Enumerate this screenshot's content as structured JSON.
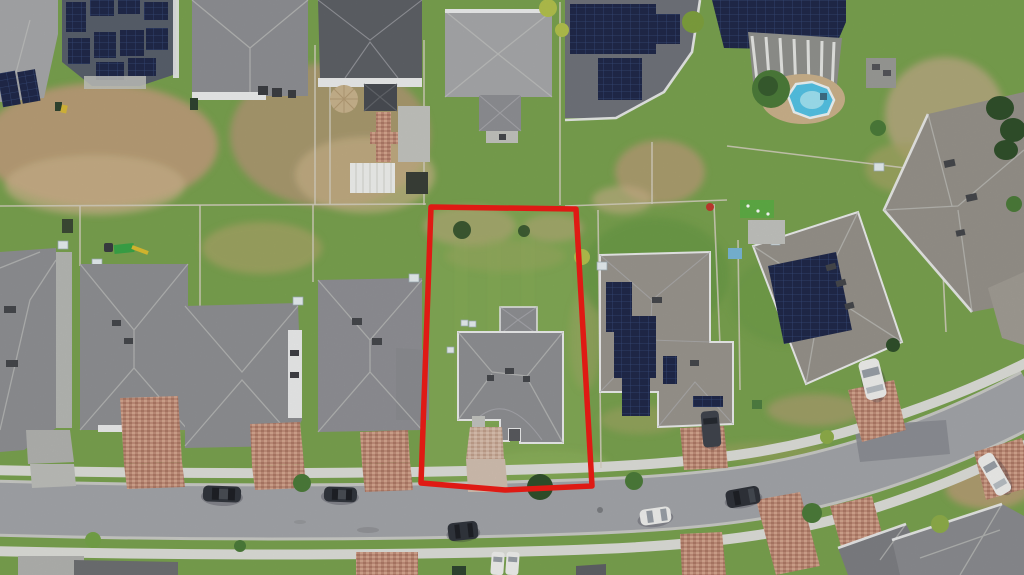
{
  "meta": {
    "title": "Aerial drone photo of a suburban neighborhood with a red boundary outline highlighting one residential lot",
    "type": "aerial-photograph",
    "width_px": 1024,
    "height_px": 575
  },
  "boundary": {
    "label": "highlighted-property-lot",
    "points": "431,207 576,209 592,486 505,490 421,483",
    "stroke_width": 5.5
  },
  "colors": {
    "grass": "#7aa24f",
    "grassLight": "#96ba64",
    "grassDark": "#5e8a41",
    "grassDry": "#a6a567",
    "dirt": "#b89e76",
    "dirtLight": "#ccb38c",
    "road": "#a3a5a9",
    "roadDark": "#8b8d92",
    "roadEdge": "#c9cac6",
    "sidewalk": "#dddfd9",
    "concrete": "#c3c4bf",
    "roofGray": "#8f9094",
    "roofLight": "#a7a8ab",
    "roofDark": "#5e6167",
    "roofWarm": "#97938b",
    "roofNavy": "#59606c",
    "roofCharcoal": "#9a968e",
    "gutter": "#eceded",
    "panel": "#20294a",
    "panelLight": "#41598c",
    "brick": "#c28e7a",
    "brickLight": "#d5a78f",
    "brickDark": "#ae7a66",
    "brickPale": "#d0b4a2",
    "pool": "#55c4e6",
    "poolLight": "#9fe4f4",
    "boundaryRed": "#ee1c16",
    "treeDark": "#30502b",
    "tree": "#4c7c3a",
    "treeLight": "#76a549",
    "shrubYellow": "#b4c24d",
    "white": "#f0f1ee",
    "carDark": "#32363d",
    "vanDark": "#40454d"
  },
  "scene": {
    "street": {
      "name": "residential-street",
      "shape": "curves upward to the right",
      "sidewalks": [
        "north",
        "south"
      ]
    },
    "highlighted_lot": {
      "contains": [
        "patchy-lawn",
        "hip-roof-house",
        "paver-driveway",
        "two-ac-units",
        "two-shrubs"
      ],
      "outline_color": "red"
    },
    "top_row_homes": [
      {
        "name": "left-edge-home",
        "solar_panels": true
      },
      {
        "name": "large-solar-home",
        "solar_panels": true,
        "roof": "dark blue-gray"
      },
      {
        "name": "gray-roof-home-with-patio",
        "backyard": [
          "patio-furniture"
        ]
      },
      {
        "name": "dark-roof-home",
        "backyard": [
          "tan-umbrella",
          "gazebo",
          "brick-path",
          "white-shed",
          "dark-trailer"
        ]
      },
      {
        "name": "pyramid-roof-home",
        "rear_addition": true
      },
      {
        "name": "solar-home-mid",
        "solar_panels": true
      },
      {
        "name": "lanai-pool-home",
        "solar_panels": true,
        "features": [
          "screened-lanai",
          "above-ground-pool",
          "sand-deck"
        ]
      },
      {
        "name": "top-right-warm-roof-home",
        "hedge": true
      }
    ],
    "south_row_homes": [
      {
        "name": "far-left-home",
        "driveway": "concrete"
      },
      {
        "name": "home-b",
        "driveway": "brick-pavers",
        "backyard": [
          "playground"
        ]
      },
      {
        "name": "home-c",
        "driveway": "brick-pavers"
      },
      {
        "name": "home-d",
        "driveway": "brick-pavers"
      },
      {
        "name": "highlighted-lot-home",
        "driveway": "pale-pavers"
      },
      {
        "name": "solar-home-e",
        "solar_panels": true,
        "vehicle": "dark-van"
      },
      {
        "name": "solar-home-f",
        "solar_panels": true,
        "vehicle": "white-car"
      }
    ],
    "vehicles": [
      {
        "type": "sedan",
        "color": "dark",
        "location": "street-left"
      },
      {
        "type": "sedan",
        "color": "dark",
        "location": "street-left-2"
      },
      {
        "type": "suv",
        "color": "dark",
        "location": "street-center"
      },
      {
        "type": "car",
        "color": "white",
        "location": "street-center-right"
      },
      {
        "type": "suv",
        "color": "dark",
        "location": "street-right"
      },
      {
        "type": "suv",
        "color": "white",
        "location": "street-far-right-parked"
      },
      {
        "type": "van",
        "color": "dark",
        "location": "driveway-solar-home-e"
      },
      {
        "type": "car",
        "color": "white",
        "location": "driveway-solar-home-f"
      },
      {
        "type": "car",
        "color": "white",
        "location": "bottom-driveway-1"
      },
      {
        "type": "car",
        "color": "white",
        "location": "bottom-driveway-2"
      }
    ],
    "vegetation": [
      "street-trees",
      "round-tree-near-pool",
      "yellow-green-shrubs",
      "hedge-top-right",
      "lawn-dirt-patches"
    ]
  }
}
